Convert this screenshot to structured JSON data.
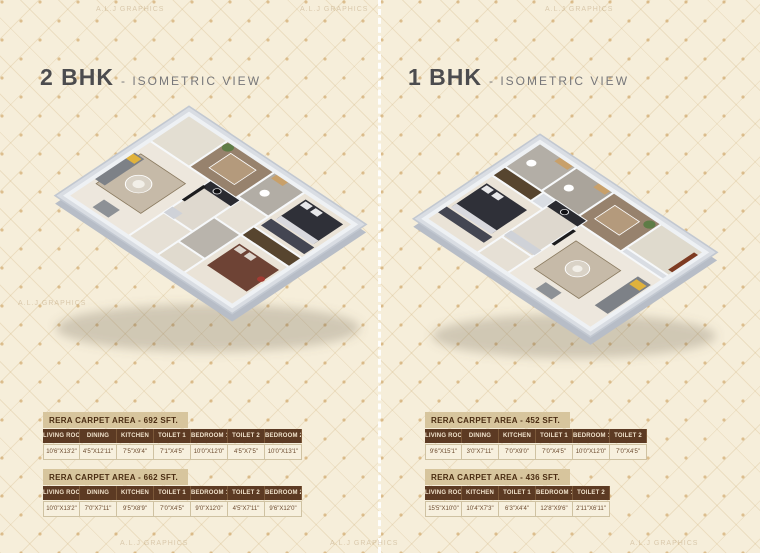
{
  "page": {
    "watermark": "A.L.J GRAPHICS",
    "theme": {
      "background": "#f6eeda",
      "table_header_brown": "#5c3a23",
      "table_title_tan": "#d7c59d",
      "table_value_cream": "#f7f0de",
      "title_gray": "#4c4c4e"
    }
  },
  "panels": [
    {
      "id": "2bhk",
      "title": "2 BHK",
      "subtitle": "- ISOMETRIC VIEW",
      "floorplan_alt": "2 BHK isometric 3D floor plan",
      "tables": [
        {
          "title": "RERA CARPET AREA - 692 SFT.",
          "columns": [
            "LIVING ROOM",
            "DINING",
            "KITCHEN",
            "TOILET 1",
            "BEDROOM 1",
            "TOILET 2",
            "BEDROOM 2"
          ],
          "values": [
            "10'6\"X13'2\"",
            "4'5\"X12'11\"",
            "7'5\"X9'4\"",
            "7'1\"X4'5\"",
            "10'0\"X12'0\"",
            "4'5\"X7'5\"",
            "10'0\"X13'1\""
          ]
        },
        {
          "title": "RERA CARPET AREA - 662 SFT.",
          "columns": [
            "LIVING ROOM",
            "DINING",
            "KITCHEN",
            "TOILET 1",
            "BEDROOM 1",
            "TOILET 2",
            "BEDROOM 2"
          ],
          "values": [
            "10'0\"X13'2\"",
            "7'0\"X7'11\"",
            "9'5\"X8'9\"",
            "7'0\"X4'5\"",
            "9'0\"X12'0\"",
            "4'5\"X7'11\"",
            "9'6\"X12'0\""
          ]
        }
      ]
    },
    {
      "id": "1bhk",
      "title": "1 BHK",
      "subtitle": "- ISOMETRIC VIEW",
      "floorplan_alt": "1 BHK isometric 3D floor plan",
      "tables": [
        {
          "title": "RERA CARPET AREA - 452 SFT.",
          "columns": [
            "LIVING ROOM",
            "DINING",
            "KITCHEN",
            "TOILET 1",
            "BEDROOM 1",
            "TOILET 2"
          ],
          "values": [
            "9'6\"X15'1\"",
            "3'0\"X7'11\"",
            "7'0\"X9'0\"",
            "7'0\"X4'5\"",
            "10'0\"X12'0\"",
            "7'0\"X4'5\""
          ]
        },
        {
          "title": "RERA CARPET AREA - 436 SFT.",
          "columns": [
            "LIVING ROOM",
            "KITCHEN",
            "TOILET 1",
            "BEDROOM 1",
            "TOILET 2"
          ],
          "values": [
            "15'5\"X10'0\"",
            "10'4\"X7'3\"",
            "6'3\"X4'4\"",
            "12'8\"X9'6\"",
            "2'11\"X6'11\""
          ]
        }
      ]
    }
  ]
}
